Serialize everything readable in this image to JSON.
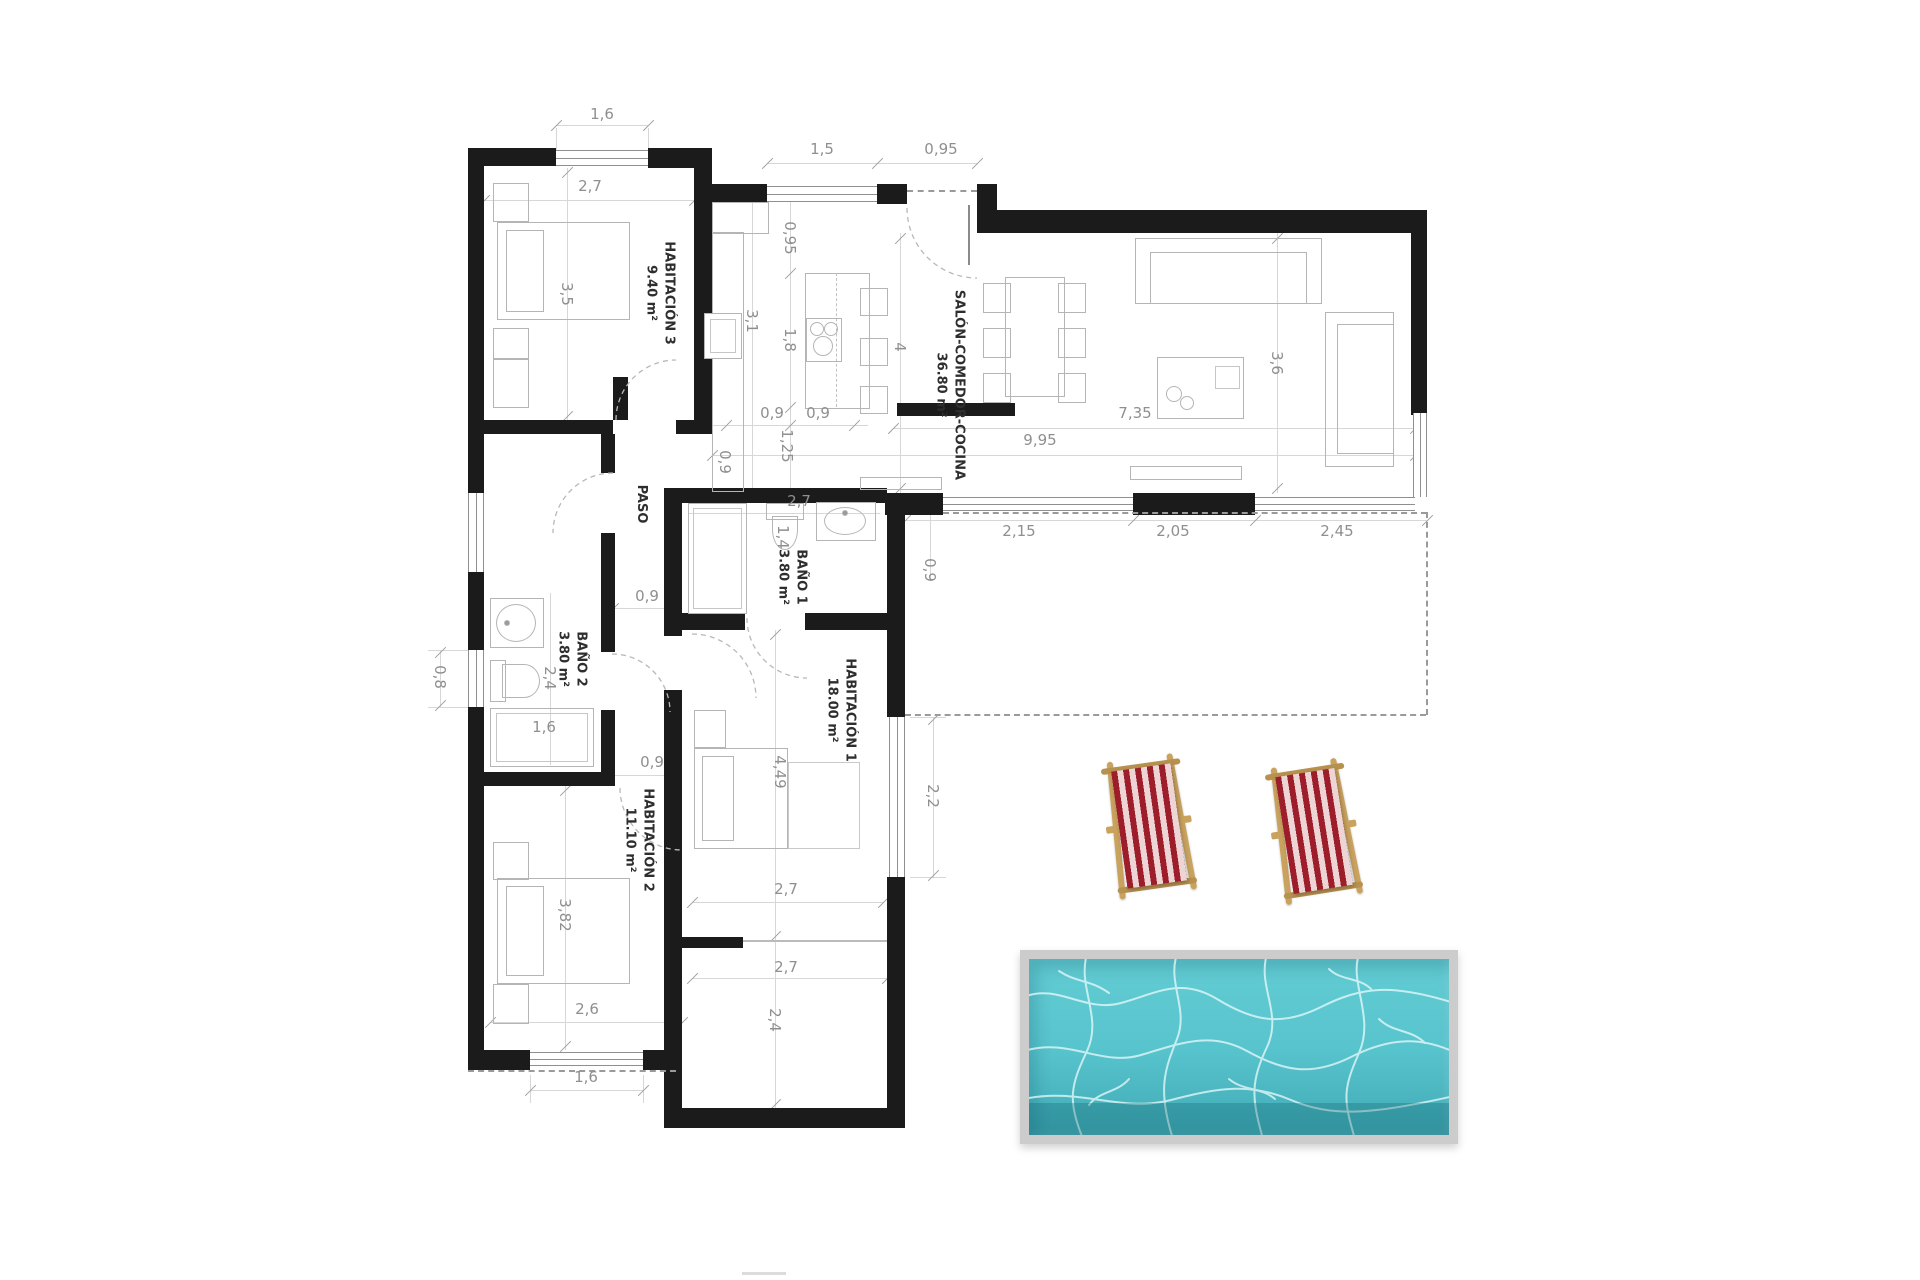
{
  "rooms": {
    "hab3": {
      "name": "HABITACIÓN 3",
      "area": "9.40 m²"
    },
    "salon": {
      "name": "SALÓN-COMEDOR-COCINA",
      "area": "36.80 m²"
    },
    "paso": {
      "name": "PASO"
    },
    "bano1": {
      "name": "BAÑO 1",
      "area": "3.80 m²"
    },
    "bano2": {
      "name": "BAÑO 2",
      "area": "3.80 m²"
    },
    "hab1": {
      "name": "HABITACIÓN 1",
      "area": "18.00 m²"
    },
    "hab2": {
      "name": "HABITACIÓN 2",
      "area": "11.10 m²"
    }
  },
  "dims": {
    "win_hab3_top": "1,6",
    "hab3_w": "2,7",
    "hab3_h": "3,5",
    "win_kitchen": "1,5",
    "entry": "0,95",
    "kitchen_gap": "0,95",
    "kitchen_h": "3,1",
    "island_len": "1,8",
    "salon_d": "4",
    "island_l": "0,9",
    "island_r": "0,9",
    "pass_125": "1,25",
    "pass_09": "0,9",
    "salon_w995": "9,95",
    "salon_w735": "7,35",
    "salon_h36": "3,6",
    "ter_215": "2,15",
    "ter_205": "2,05",
    "ter_245": "2,45",
    "ter_09": "0,9",
    "bano1_w": "2,7",
    "bano1_h": "1,4",
    "paso_09": "0,9",
    "bano2_h": "2,4",
    "bano2_win": "0,8",
    "tub": "1,6",
    "hab2_door": "0,9",
    "hab1_h": "4,49",
    "hab1_win": "2,2",
    "hab1_w": "2,7",
    "porch_w": "2,7",
    "porch_h": "2,4",
    "hab2_bed": "3,82",
    "hab2_w": "2,6",
    "hab2_win": "1,6"
  },
  "colors": {
    "wall": "#1b1b1b",
    "dim_text": "#8f8f8f",
    "room_text": "#2e2e2e",
    "furniture_line": "#b5b5b5",
    "pool_water": "#57c3cc",
    "pool_water_dark": "#3fa3ae",
    "pool_frame": "#cccccc",
    "chair_red": "#9e1d2a",
    "chair_stripe_light": "#edd5d5",
    "chair_wood": "#c9a25e"
  }
}
